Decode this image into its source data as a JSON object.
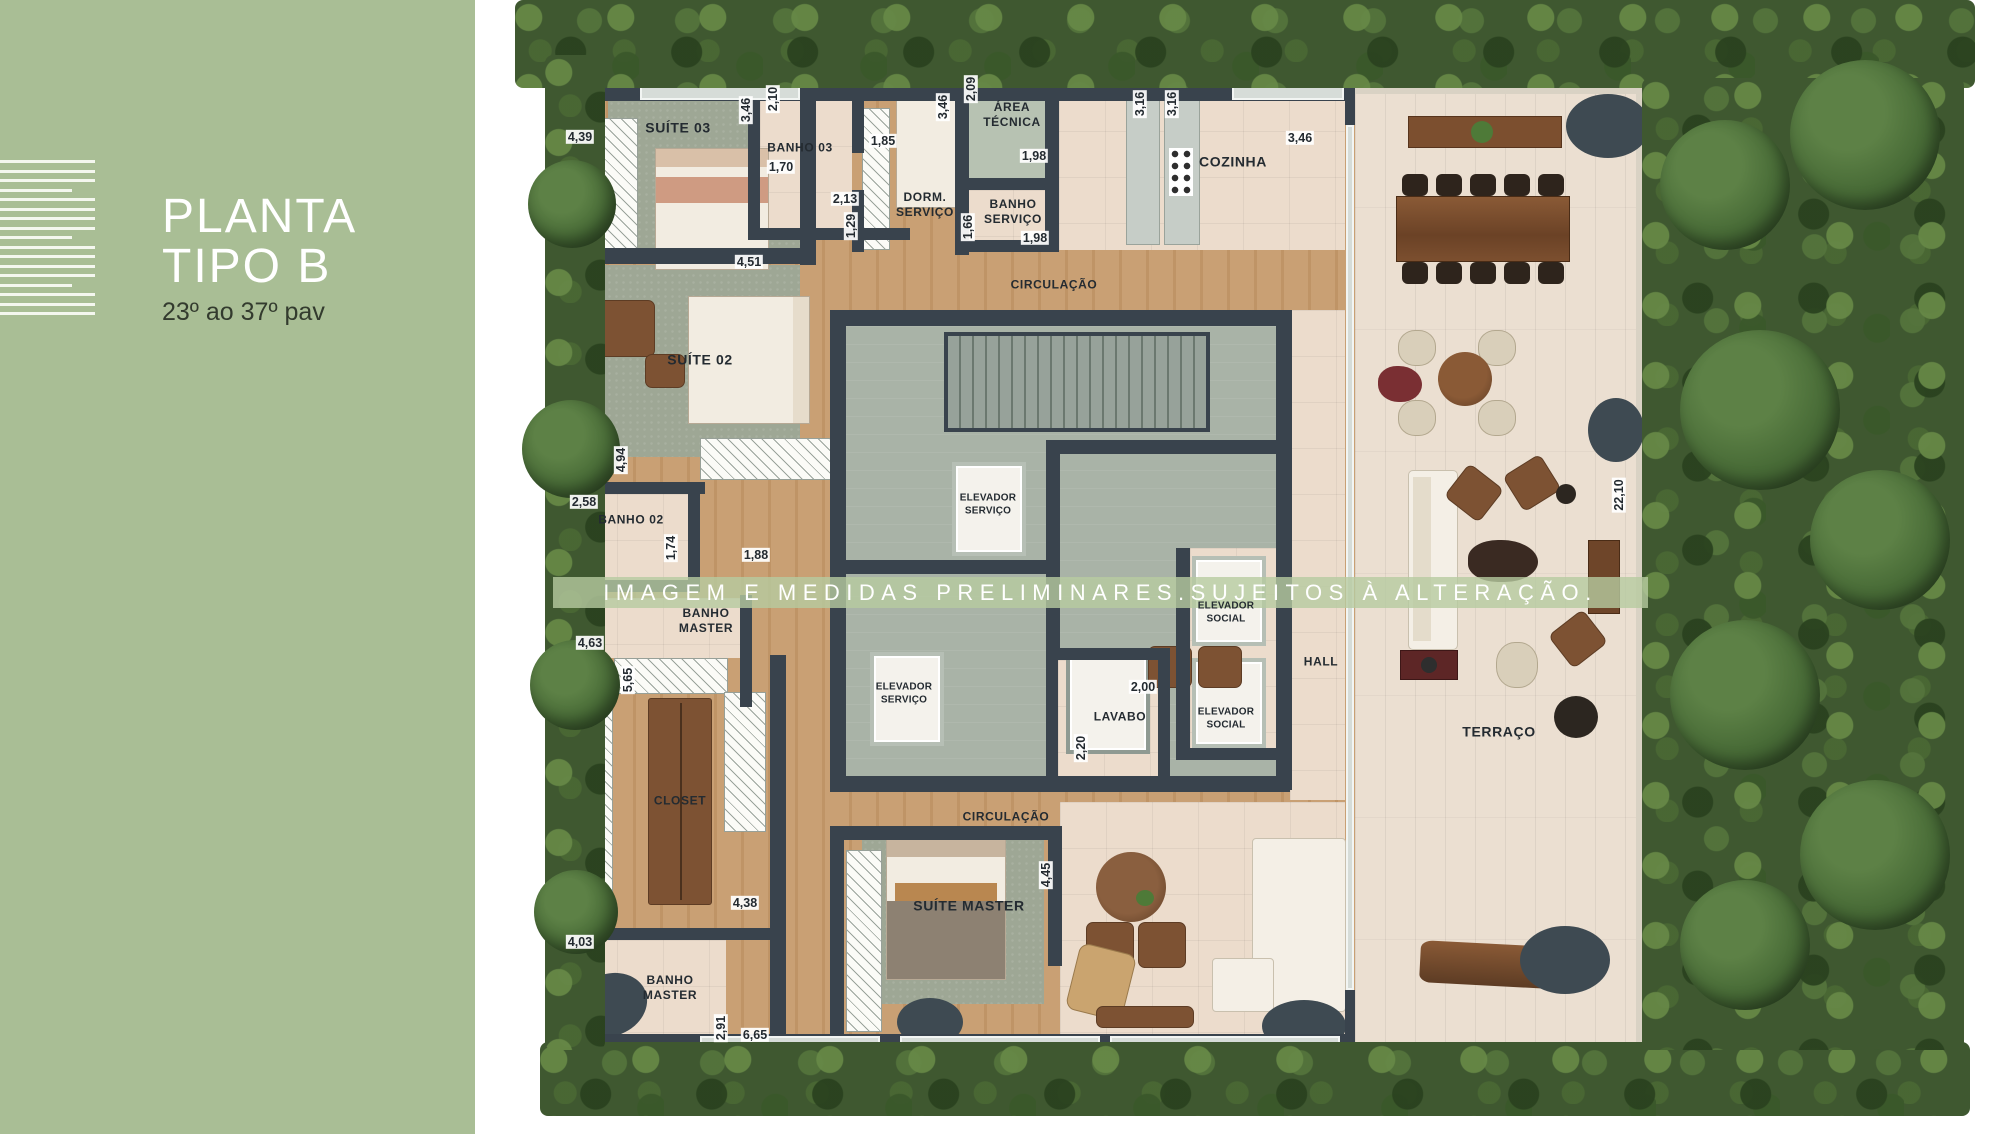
{
  "sidebar": {
    "title_line1": "PLANTA",
    "title_line2": "TIPO B",
    "subtitle": "23º ao 37º pav"
  },
  "watermark": {
    "text": "IMAGEM E MEDIDAS PRELIMINARES.SUJEITOS À ALTERAÇÃO."
  },
  "plan": {
    "room_labels": [
      {
        "id": "suite-03",
        "lines": [
          "SUÍTE 03"
        ],
        "x": 678,
        "y": 128
      },
      {
        "id": "banho-03",
        "lines": [
          "BANHO 03"
        ],
        "x": 800,
        "y": 148,
        "size": "sm"
      },
      {
        "id": "dorm-servico",
        "lines": [
          "DORM.",
          "SERVIÇO"
        ],
        "x": 925,
        "y": 205,
        "size": "sm"
      },
      {
        "id": "area-tecnica",
        "lines": [
          "ÁREA",
          "TÉCNICA"
        ],
        "x": 1012,
        "y": 115,
        "size": "sm"
      },
      {
        "id": "banho-servico",
        "lines": [
          "BANHO",
          "SERVIÇO"
        ],
        "x": 1013,
        "y": 212,
        "size": "sm"
      },
      {
        "id": "cozinha",
        "lines": [
          "COZINHA"
        ],
        "x": 1233,
        "y": 162
      },
      {
        "id": "circulacao-superior",
        "lines": [
          "CIRCULAÇÃO"
        ],
        "x": 1054,
        "y": 285,
        "size": "sm"
      },
      {
        "id": "suite-02",
        "lines": [
          "SUÍTE 02"
        ],
        "x": 700,
        "y": 360
      },
      {
        "id": "banho-02",
        "lines": [
          "BANHO 02"
        ],
        "x": 631,
        "y": 520,
        "size": "sm"
      },
      {
        "id": "elevador-servico-1",
        "lines": [
          "ELEVADOR",
          "SERVIÇO"
        ],
        "x": 988,
        "y": 505,
        "size": "xs"
      },
      {
        "id": "elevador-servico-2",
        "lines": [
          "ELEVADOR",
          "SERVIÇO"
        ],
        "x": 904,
        "y": 694,
        "size": "xs"
      },
      {
        "id": "elevador-social-1",
        "lines": [
          "ELEVADOR",
          "SOCIAL"
        ],
        "x": 1226,
        "y": 613,
        "size": "xs"
      },
      {
        "id": "elevador-social-2",
        "lines": [
          "ELEVADOR",
          "SOCIAL"
        ],
        "x": 1226,
        "y": 719,
        "size": "xs"
      },
      {
        "id": "lavabo",
        "lines": [
          "LAVABO"
        ],
        "x": 1120,
        "y": 717,
        "size": "sm"
      },
      {
        "id": "hall",
        "lines": [
          "HALL"
        ],
        "x": 1321,
        "y": 662,
        "size": "sm"
      },
      {
        "id": "banho-master-superior",
        "lines": [
          "BANHO",
          "MASTER"
        ],
        "x": 706,
        "y": 621,
        "size": "sm"
      },
      {
        "id": "closet",
        "lines": [
          "CLOSET"
        ],
        "x": 680,
        "y": 801,
        "size": "sm"
      },
      {
        "id": "banho-master-inferior",
        "lines": [
          "BANHO",
          "MASTER"
        ],
        "x": 670,
        "y": 988,
        "size": "sm"
      },
      {
        "id": "suite-master",
        "lines": [
          "SUÍTE MASTER"
        ],
        "x": 969,
        "y": 906
      },
      {
        "id": "circulacao-inferior",
        "lines": [
          "CIRCULAÇÃO"
        ],
        "x": 1006,
        "y": 817,
        "size": "sm"
      },
      {
        "id": "terraco",
        "lines": [
          "TERRAÇO"
        ],
        "x": 1499,
        "y": 732
      }
    ],
    "dimension_labels": [
      {
        "value": "4,39",
        "x": 580,
        "y": 137
      },
      {
        "value": "3,46",
        "x": 746,
        "y": 110,
        "vertical": true
      },
      {
        "value": "2,10",
        "x": 773,
        "y": 99,
        "vertical": true
      },
      {
        "value": "1,70",
        "x": 781,
        "y": 167
      },
      {
        "value": "1,85",
        "x": 883,
        "y": 141
      },
      {
        "value": "2,13",
        "x": 845,
        "y": 199
      },
      {
        "value": "1,29",
        "x": 851,
        "y": 226,
        "vertical": true
      },
      {
        "value": "3,46",
        "x": 943,
        "y": 107,
        "vertical": true
      },
      {
        "value": "2,09",
        "x": 971,
        "y": 89,
        "vertical": true
      },
      {
        "value": "1,98",
        "x": 1034,
        "y": 156
      },
      {
        "value": "1,66",
        "x": 968,
        "y": 227,
        "vertical": true
      },
      {
        "value": "1,98",
        "x": 1035,
        "y": 238
      },
      {
        "value": "3,16",
        "x": 1140,
        "y": 104,
        "vertical": true
      },
      {
        "value": "3,16",
        "x": 1172,
        "y": 104,
        "vertical": true
      },
      {
        "value": "3,46",
        "x": 1300,
        "y": 138
      },
      {
        "value": "4,51",
        "x": 749,
        "y": 262
      },
      {
        "value": "4,94",
        "x": 621,
        "y": 460,
        "vertical": true
      },
      {
        "value": "2,58",
        "x": 584,
        "y": 502
      },
      {
        "value": "1,74",
        "x": 671,
        "y": 548,
        "vertical": true
      },
      {
        "value": "1,88",
        "x": 756,
        "y": 555
      },
      {
        "value": "4,63",
        "x": 590,
        "y": 643
      },
      {
        "value": "5,65",
        "x": 628,
        "y": 680,
        "vertical": true
      },
      {
        "value": "4,38",
        "x": 745,
        "y": 903
      },
      {
        "value": "4,03",
        "x": 580,
        "y": 942
      },
      {
        "value": "2,91",
        "x": 721,
        "y": 1028,
        "vertical": true
      },
      {
        "value": "6,65",
        "x": 755,
        "y": 1035
      },
      {
        "value": "2,00",
        "x": 1143,
        "y": 687
      },
      {
        "value": "2,20",
        "x": 1081,
        "y": 748,
        "vertical": true
      },
      {
        "value": "4,45",
        "x": 1046,
        "y": 875,
        "vertical": true
      },
      {
        "value": "22,10",
        "x": 1619,
        "y": 495,
        "vertical": true
      }
    ]
  },
  "colors": {
    "sidebar_green": "#a9be95",
    "wall_dark": "#39434d",
    "wood_floor": "#c9a074",
    "carpet_green": "#9ea795",
    "tile_beige": "#ecdccc",
    "terrace_tile": "#ebdfd1",
    "core_gray": "#a9b3a7",
    "hedge_green": "#3f5830",
    "watermark_band": "rgba(183,202,160,0.8)"
  }
}
